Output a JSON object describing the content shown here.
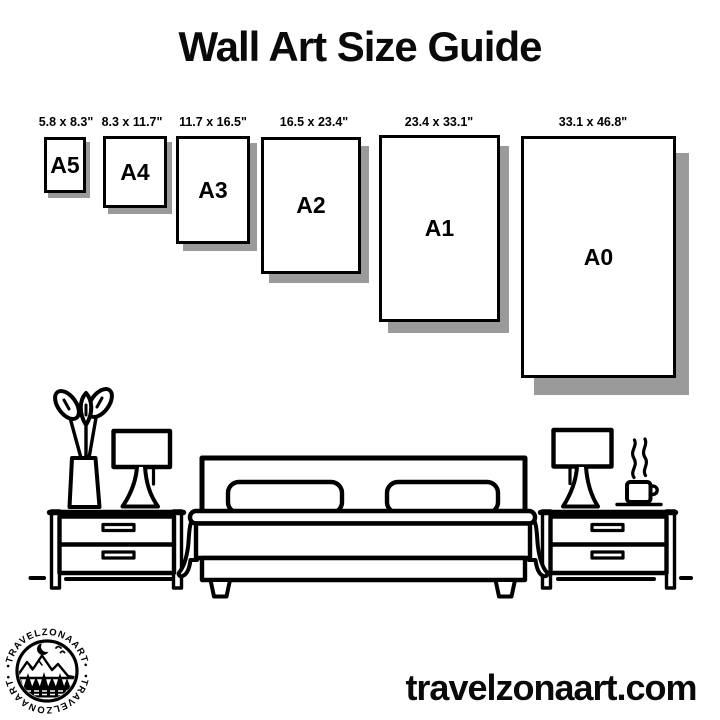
{
  "title": "Wall Art Size Guide",
  "sizes": [
    {
      "name": "A5",
      "dims": "5.8 x 8.3\""
    },
    {
      "name": "A4",
      "dims": "8.3 x 11.7\""
    },
    {
      "name": "A3",
      "dims": "11.7 x 16.5\""
    },
    {
      "name": "A2",
      "dims": "16.5 x 23.4\""
    },
    {
      "name": "A1",
      "dims": "23.4 x 33.1\""
    },
    {
      "name": "A0",
      "dims": "33.1 x 46.8\""
    }
  ],
  "logo": {
    "ring_text_top": "•TRAVELZONAART•",
    "ring_text_bottom": "•TRAVELZONAART•"
  },
  "footer": {
    "website": "travelzonaart.com"
  },
  "colors": {
    "ink": "#000000",
    "paper_shadow": "#9a9a9a",
    "background": "#ffffff"
  }
}
